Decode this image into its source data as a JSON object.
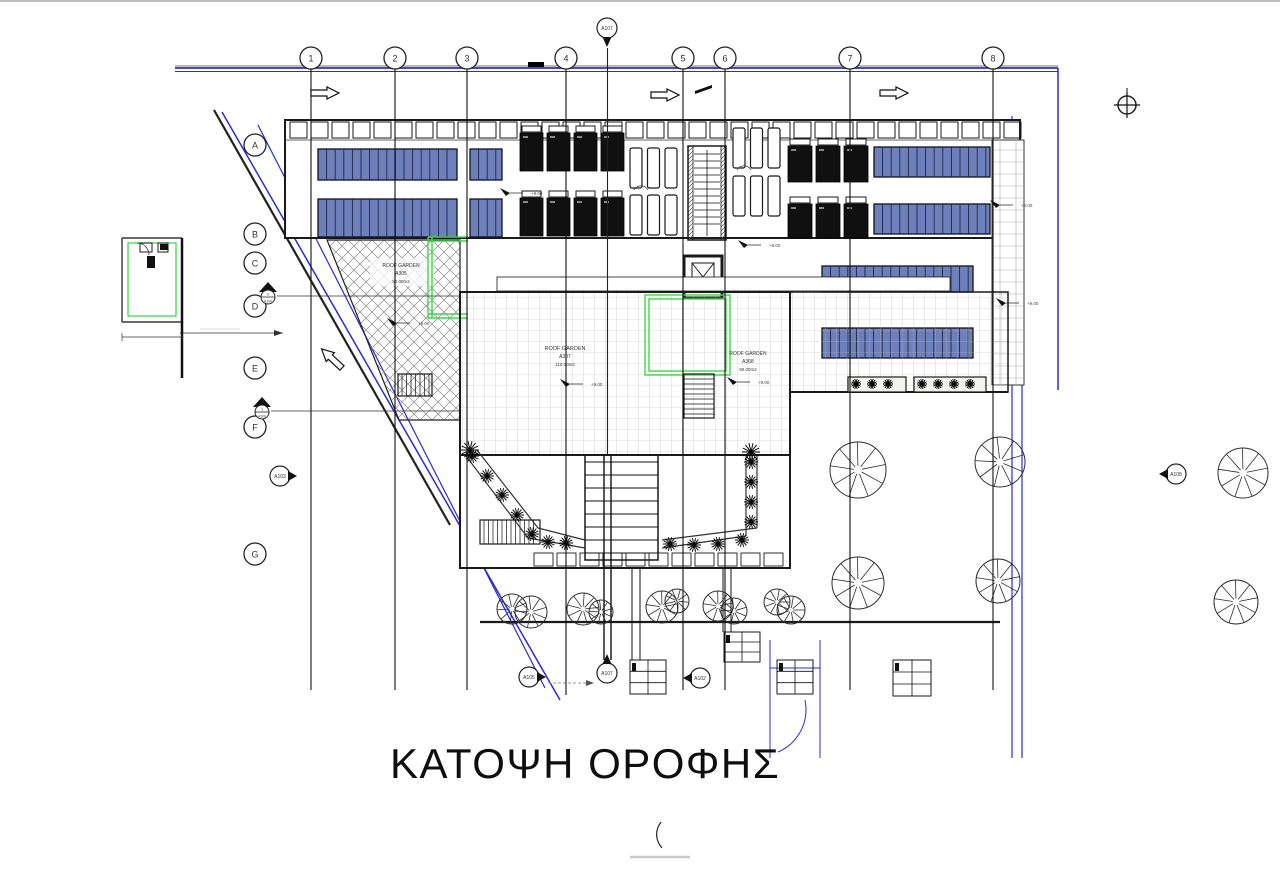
{
  "page": {
    "title_label": "ΚΑΤΟΨΗ ΟΡΟΦΗΣ"
  },
  "grid": {
    "columns": [
      "1",
      "2",
      "3",
      "4",
      "5",
      "6",
      "7",
      "8"
    ],
    "rows": [
      "A",
      "B",
      "C",
      "D",
      "E",
      "F",
      "G"
    ]
  },
  "roof_gardens": [
    {
      "label": "ROOF GARDEN",
      "code": "A305",
      "area": "50.00m2"
    },
    {
      "label": "ROOF GARDEN",
      "code": "A307",
      "area": "110.00m2"
    },
    {
      "label": "ROOF GARDEN",
      "code": "A308",
      "area": "90.00m2"
    }
  ],
  "level_marker": "+9.00",
  "markers": {
    "section_top": "A107",
    "section_bottom": "A107",
    "section_left": "A103",
    "section_right": "A108",
    "section_bottom_left": "A105",
    "section_bottom_mid": "A102",
    "detail_d_num": "2",
    "detail_d_sheet": "A100",
    "detail_f_num": "1",
    "detail_f_sheet": "A100"
  },
  "colors": {
    "boundary_blue": "#2b2bd6",
    "panel_blue": "#6e80bb",
    "garden_green": "#3fd84b",
    "ink": "#1a1a1a"
  }
}
